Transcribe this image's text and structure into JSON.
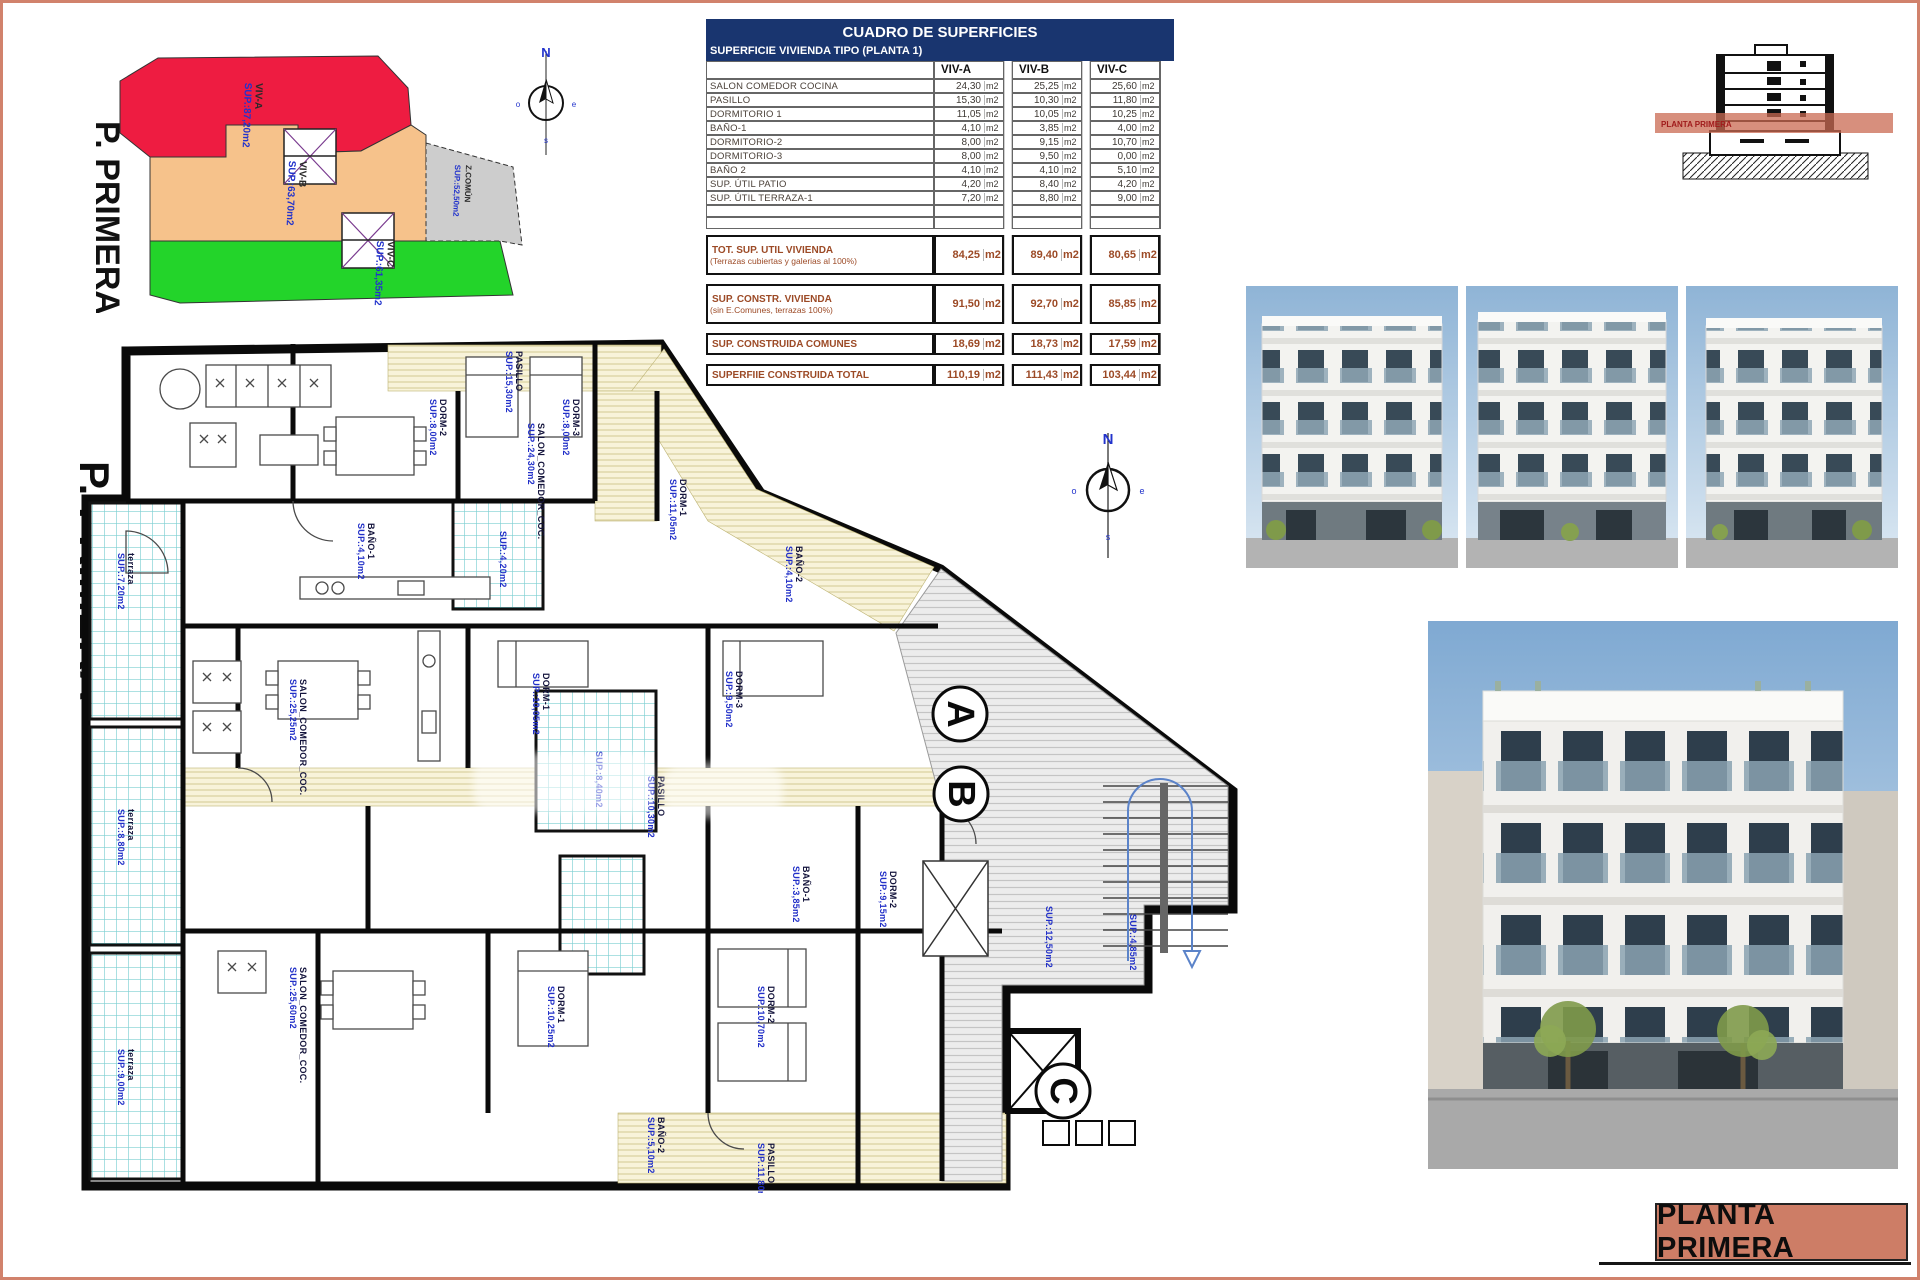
{
  "sheet": {
    "border_color": "#d1826c"
  },
  "title_block": {
    "text": "PLANTA PRIMERA"
  },
  "section_thumb": {
    "band_label": "PLANTA PRIMERA"
  },
  "site_plan": {
    "floor_label": "P. PRIMERA",
    "compass": {
      "n": "N",
      "e": "e",
      "s": "s",
      "o": "o"
    },
    "zones": [
      {
        "id": "viv-a",
        "name": "VIV-A",
        "sup": "SUP.:87,20m2",
        "color": "#ee1c41"
      },
      {
        "id": "viv-b",
        "name": "VIV-B",
        "sup": "SUP.:63,70m2",
        "color": "#f6c28b"
      },
      {
        "id": "viv-c",
        "name": "VIV-C",
        "sup": "SUP.:61,35m2",
        "color": "#23d42a"
      },
      {
        "id": "z-comun",
        "name": "Z.COMÚN",
        "sup": "SUP.:52,50m2",
        "color": "#cdcdcd"
      }
    ]
  },
  "areas_table": {
    "title": "CUADRO DE SUPERFICIES",
    "subtitle": "SUPERFICIE VIVIENDA TIPO  (PLANTA 1)",
    "columns": [
      "VIV-A",
      "VIV-B",
      "VIV-C"
    ],
    "unit": "m2",
    "rows": [
      {
        "label": "SALON COMEDOR COCINA",
        "values": [
          "24,30",
          "25,25",
          "25,60"
        ]
      },
      {
        "label": "PASILLO",
        "values": [
          "15,30",
          "10,30",
          "11,80"
        ]
      },
      {
        "label": "DORMITORIO 1",
        "values": [
          "11,05",
          "10,05",
          "10,25"
        ]
      },
      {
        "label": "BAÑO-1",
        "values": [
          "4,10",
          "3,85",
          "4,00"
        ]
      },
      {
        "label": "DORMITORIO-2",
        "values": [
          "8,00",
          "9,15",
          "10,70"
        ]
      },
      {
        "label": "DORMITORIO-3",
        "values": [
          "8,00",
          "9,50",
          "0,00"
        ]
      },
      {
        "label": "BAÑO 2",
        "values": [
          "4,10",
          "4,10",
          "5,10"
        ]
      },
      {
        "label": "SUP. ÚTIL PATIO",
        "values": [
          "4,20",
          "8,40",
          "4,20"
        ]
      },
      {
        "label": "SUP. ÚTIL TERRAZA-1",
        "values": [
          "7,20",
          "8,80",
          "9,00"
        ]
      }
    ],
    "summary": [
      {
        "label": "TOT. SUP. UTIL VIVIENDA",
        "sublabel": "(Terrazas cubiertas y galerias al 100%)",
        "values": [
          "84,25",
          "89,40",
          "80,65"
        ]
      },
      {
        "label": "SUP. CONSTR. VIVIENDA",
        "sublabel": "(sin E.Comunes, terrazas 100%)",
        "values": [
          "91,50",
          "92,70",
          "85,85"
        ]
      },
      {
        "label": "SUP. CONSTRUIDA COMUNES",
        "values": [
          "18,69",
          "18,73",
          "17,59"
        ]
      },
      {
        "label": "SUPERFIIE CONSTRUIDA TOTAL",
        "values": [
          "110,19",
          "111,43",
          "103,44"
        ]
      }
    ]
  },
  "floor_plan": {
    "floor_label": "P. PRIMERA",
    "compass": {
      "n": "N",
      "e": "e",
      "s": "s",
      "o": "o"
    },
    "unit_markers": [
      {
        "letter": "A",
        "x": 892,
        "y": 383
      },
      {
        "letter": "B",
        "x": 893,
        "y": 463
      },
      {
        "letter": "C",
        "x": 995,
        "y": 760
      }
    ],
    "labels": [
      {
        "name": "PASILLO",
        "sup": "SUP.:15,30m2",
        "x": 448,
        "y": 20,
        "rot": 90
      },
      {
        "name": "DORM-2",
        "sup": "SUP.:8,00m2",
        "x": 372,
        "y": 68,
        "rot": 90
      },
      {
        "name": "DORM-3",
        "sup": "SUP.:8,00m2",
        "x": 505,
        "y": 68,
        "rot": 90
      },
      {
        "name": "SALON_COMEDOR_COC.",
        "sup": "SUP.:24,30m2",
        "x": 470,
        "y": 92,
        "rot": 90
      },
      {
        "name": "DORM-1",
        "sup": "SUP.:11,05m2",
        "x": 612,
        "y": 148,
        "rot": 90
      },
      {
        "name": "BAÑO-1",
        "sup": "SUP.:4,10m2",
        "x": 300,
        "y": 192,
        "rot": 90
      },
      {
        "name": "",
        "sup": "SUP.:4,20m2",
        "x": 432,
        "y": 200,
        "rot": 90
      },
      {
        "name": "BAÑO-2",
        "sup": "SUP.:4,10m2",
        "x": 728,
        "y": 215,
        "rot": 90
      },
      {
        "name": "DORM-3",
        "sup": "SUP.:9,50m2",
        "x": 668,
        "y": 340,
        "rot": 90
      },
      {
        "name": "SALON_COMEDOR_COC.",
        "sup": "SUP.:25,25m2",
        "x": 232,
        "y": 348,
        "rot": 90
      },
      {
        "name": "DORM-1",
        "sup": "SUP.:10,05m2",
        "x": 475,
        "y": 342,
        "rot": 90
      },
      {
        "name": "",
        "sup": "SUP.:8,40m2",
        "x": 528,
        "y": 420,
        "rot": 90
      },
      {
        "name": "PASILLO",
        "sup": "SUP.:10,30m2",
        "x": 590,
        "y": 445,
        "rot": 90
      },
      {
        "name": "BAÑO-1",
        "sup": "SUP.:3,85m2",
        "x": 735,
        "y": 535,
        "rot": 90
      },
      {
        "name": "DORM-2",
        "sup": "SUP.:9,15m2",
        "x": 822,
        "y": 540,
        "rot": 90
      },
      {
        "name": "",
        "sup": "SUP.:12,50m2",
        "x": 978,
        "y": 575,
        "rot": 90
      },
      {
        "name": "",
        "sup": "SUP.:4,85m2",
        "x": 1062,
        "y": 583,
        "rot": 90
      },
      {
        "name": "SALON_COMEDOR_COC.",
        "sup": "SUP.:25,60m2",
        "x": 232,
        "y": 636,
        "rot": 90
      },
      {
        "name": "DORM-1",
        "sup": "SUP.:10,25m2",
        "x": 490,
        "y": 655,
        "rot": 90
      },
      {
        "name": "DORM-2",
        "sup": "SUP.:10,70m2",
        "x": 700,
        "y": 655,
        "rot": 90
      },
      {
        "name": "BAÑO-2",
        "sup": "SUP.:5,10m2",
        "x": 590,
        "y": 786,
        "rot": 90
      },
      {
        "name": "PASILLO",
        "sup": "SUP.:11,80m2",
        "x": 700,
        "y": 812,
        "rot": 90
      },
      {
        "name": "terraza",
        "sup": "SUP.:7,20m2",
        "x": 60,
        "y": 222,
        "rot": 90
      },
      {
        "name": "terraza",
        "sup": "SUP.:8,80m2",
        "x": 60,
        "y": 478,
        "rot": 90
      },
      {
        "name": "terraza",
        "sup": "SUP.:9,00m2",
        "x": 60,
        "y": 718,
        "rot": 90
      }
    ]
  }
}
